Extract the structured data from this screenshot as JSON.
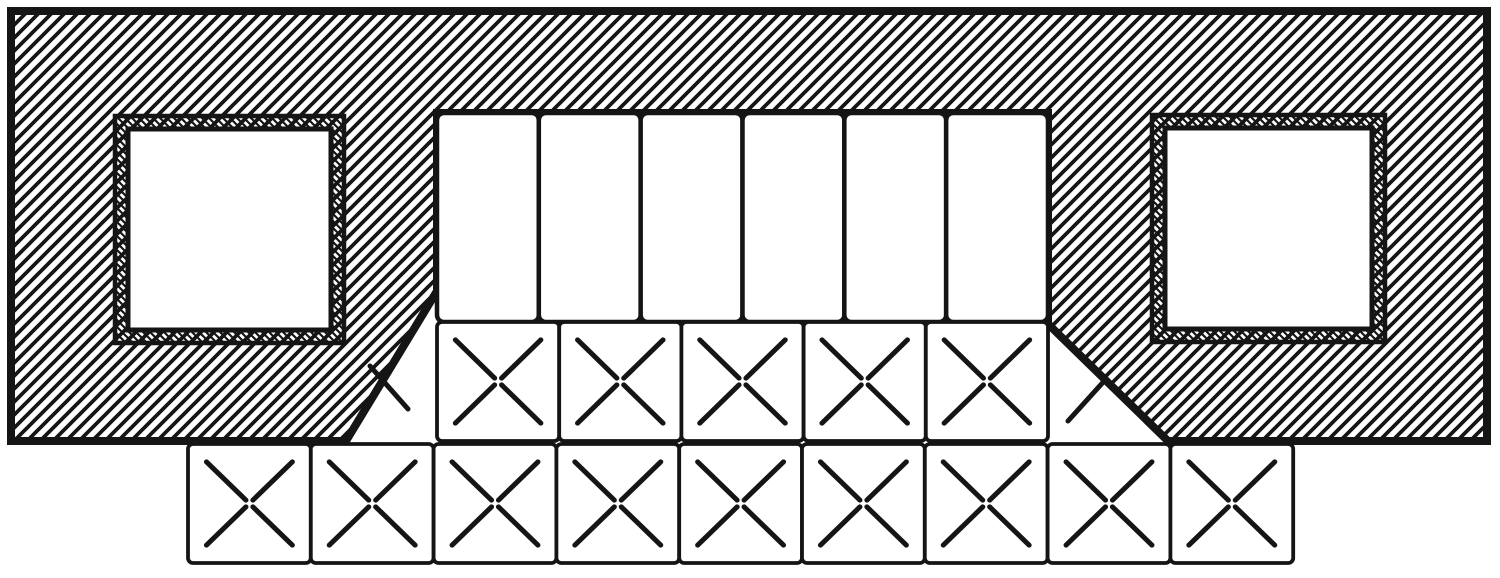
{
  "figure": {
    "kind": "engraved-cross-section-diagram",
    "background_color": "#ffffff",
    "ink_color": "#151515",
    "canvas": {
      "w": 1500,
      "h": 578
    },
    "body": {
      "outline_path": "M 11 11 H 1487 V 441 H 1168 L 1048 324 V 113 H 437 V 291 L 346 441 H 11 Z",
      "outline_stroke": 8,
      "hatch": {
        "direction": "ne",
        "pitch": 13,
        "stroke": 3.8
      }
    },
    "windows": [
      {
        "side": "left",
        "x": 115,
        "y": 116,
        "w": 229,
        "h": 227,
        "liner": 13
      },
      {
        "side": "right",
        "x": 1152,
        "y": 115,
        "w": 233,
        "h": 227,
        "liner": 13
      }
    ],
    "slots": {
      "count": 6,
      "x": 437,
      "y": 113,
      "width": 611,
      "height": 209,
      "corner_radius": 7,
      "stroke": 4.5
    },
    "tile_rows": [
      {
        "id": "recess-tile-row",
        "count": 5,
        "x": 437,
        "y": 322,
        "pitch": 122.2,
        "height": 119
      },
      {
        "id": "footing-tile-row",
        "count": 9,
        "x": 188,
        "y": 444,
        "pitch": 122.8,
        "height": 119
      }
    ],
    "tile_style": {
      "border_stroke": 3.8,
      "x_stroke": 5,
      "x_inset_ratio": 0.15,
      "x_gap_ratio": 0.46,
      "corner_radius": 5
    },
    "corner_strokes": [
      [
        370,
        366,
        408,
        409
      ],
      [
        1068,
        421,
        1106,
        379
      ]
    ]
  }
}
